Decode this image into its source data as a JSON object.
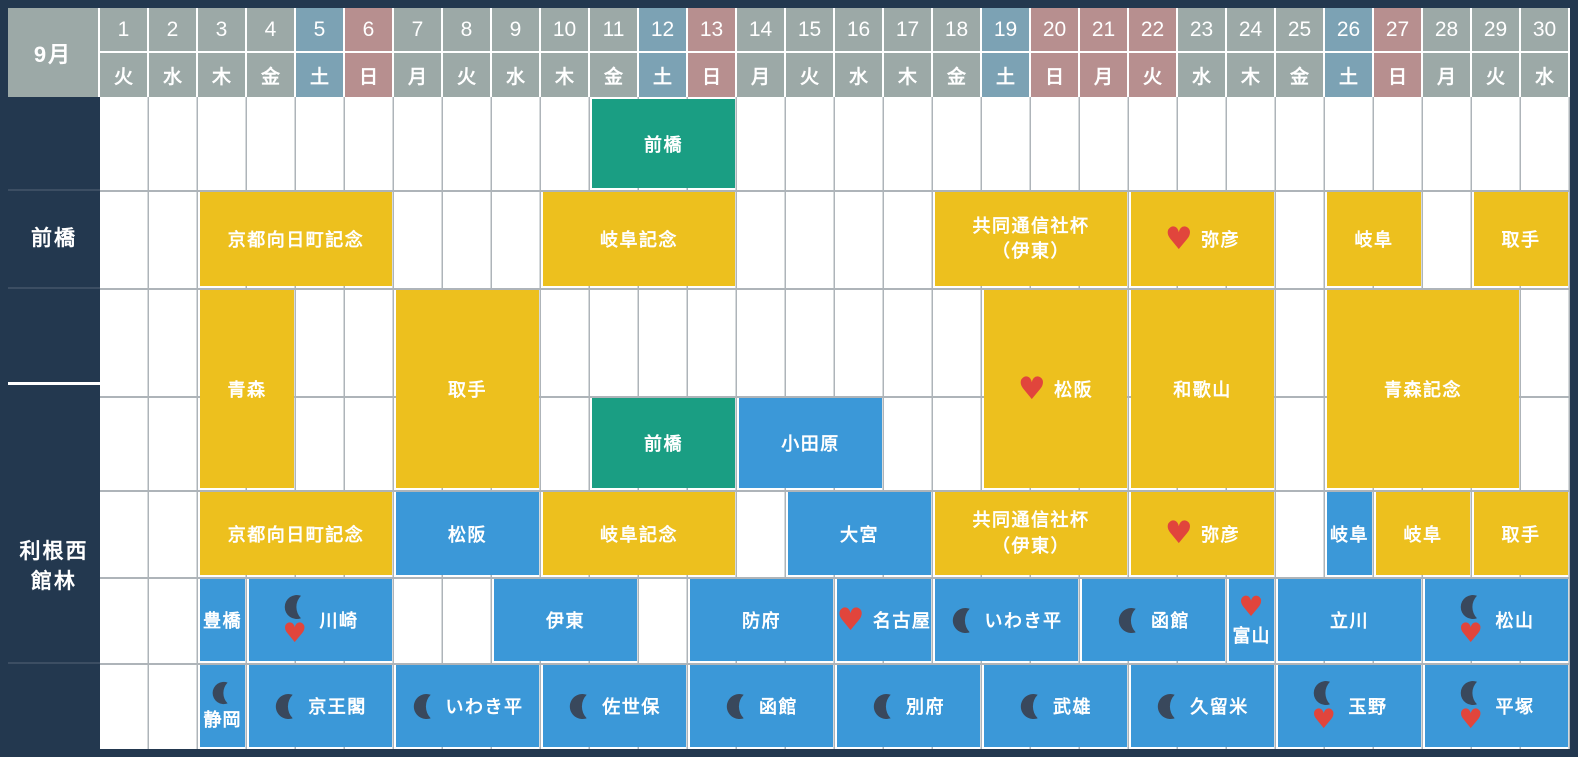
{
  "header": {
    "month_label": "9月",
    "days": [
      {
        "num": "1",
        "dow": "火",
        "type": "normal"
      },
      {
        "num": "2",
        "dow": "水",
        "type": "normal"
      },
      {
        "num": "3",
        "dow": "木",
        "type": "normal"
      },
      {
        "num": "4",
        "dow": "金",
        "type": "normal"
      },
      {
        "num": "5",
        "dow": "土",
        "type": "saturday"
      },
      {
        "num": "6",
        "dow": "日",
        "type": "holiday"
      },
      {
        "num": "7",
        "dow": "月",
        "type": "normal"
      },
      {
        "num": "8",
        "dow": "火",
        "type": "normal"
      },
      {
        "num": "9",
        "dow": "水",
        "type": "normal"
      },
      {
        "num": "10",
        "dow": "木",
        "type": "normal"
      },
      {
        "num": "11",
        "dow": "金",
        "type": "normal"
      },
      {
        "num": "12",
        "dow": "土",
        "type": "saturday"
      },
      {
        "num": "13",
        "dow": "日",
        "type": "holiday"
      },
      {
        "num": "14",
        "dow": "月",
        "type": "normal"
      },
      {
        "num": "15",
        "dow": "火",
        "type": "normal"
      },
      {
        "num": "16",
        "dow": "水",
        "type": "normal"
      },
      {
        "num": "17",
        "dow": "木",
        "type": "normal"
      },
      {
        "num": "18",
        "dow": "金",
        "type": "normal"
      },
      {
        "num": "19",
        "dow": "土",
        "type": "saturday"
      },
      {
        "num": "20",
        "dow": "日",
        "type": "holiday"
      },
      {
        "num": "21",
        "dow": "月",
        "type": "holiday"
      },
      {
        "num": "22",
        "dow": "火",
        "type": "holiday"
      },
      {
        "num": "23",
        "dow": "水",
        "type": "normal"
      },
      {
        "num": "24",
        "dow": "木",
        "type": "normal"
      },
      {
        "num": "25",
        "dow": "金",
        "type": "normal"
      },
      {
        "num": "26",
        "dow": "土",
        "type": "saturday"
      },
      {
        "num": "27",
        "dow": "日",
        "type": "holiday"
      },
      {
        "num": "28",
        "dow": "月",
        "type": "normal"
      },
      {
        "num": "29",
        "dow": "火",
        "type": "normal"
      },
      {
        "num": "30",
        "dow": "水",
        "type": "normal"
      }
    ]
  },
  "sidebar": {
    "sections": [
      {
        "label": ""
      },
      {
        "label": "前橋"
      },
      {
        "label": ""
      },
      {
        "label_lines": [
          "利根西",
          "館林"
        ]
      }
    ]
  },
  "events": [
    {
      "row": "A",
      "start": 11,
      "end": 13,
      "color": "green",
      "label": "前橋"
    },
    {
      "row": "B",
      "start": 3,
      "end": 6,
      "color": "yellow",
      "label": "京都向日町記念"
    },
    {
      "row": "B",
      "start": 10,
      "end": 13,
      "color": "yellow",
      "label": "岐阜記念"
    },
    {
      "row": "B",
      "start": 18,
      "end": 21,
      "color": "yellow",
      "lines": [
        "共同通信社杯",
        "（伊東）"
      ]
    },
    {
      "row": "B",
      "start": 22,
      "end": 24,
      "color": "yellow",
      "label": "弥彦",
      "heart": true,
      "layout": "inline"
    },
    {
      "row": "B",
      "start": 26,
      "end": 27,
      "color": "yellow",
      "label": "岐阜"
    },
    {
      "row": "B",
      "start": 29,
      "end": 30,
      "color": "yellow",
      "label": "取手"
    },
    {
      "row": "CD",
      "start": 3,
      "end": 4,
      "color": "yellow",
      "label": "青森"
    },
    {
      "row": "CD",
      "start": 7,
      "end": 9,
      "color": "yellow",
      "label": "取手"
    },
    {
      "row": "CD",
      "start": 19,
      "end": 21,
      "color": "yellow",
      "label": "松阪",
      "heart": true,
      "layout": "inline"
    },
    {
      "row": "CD",
      "start": 22,
      "end": 24,
      "color": "yellow",
      "label": "和歌山"
    },
    {
      "row": "CD",
      "start": 26,
      "end": 29,
      "color": "yellow",
      "label": "青森記念"
    },
    {
      "row": "D",
      "start": 11,
      "end": 13,
      "color": "green",
      "label": "前橋"
    },
    {
      "row": "D",
      "start": 14,
      "end": 16,
      "color": "blue",
      "label": "小田原"
    },
    {
      "row": "E",
      "start": 3,
      "end": 6,
      "color": "yellow",
      "label": "京都向日町記念"
    },
    {
      "row": "E",
      "start": 7,
      "end": 9,
      "color": "blue",
      "label": "松阪"
    },
    {
      "row": "E",
      "start": 10,
      "end": 13,
      "color": "yellow",
      "label": "岐阜記念"
    },
    {
      "row": "E",
      "start": 15,
      "end": 17,
      "color": "blue",
      "label": "大宮"
    },
    {
      "row": "E",
      "start": 18,
      "end": 21,
      "color": "yellow",
      "lines": [
        "共同通信社杯",
        "（伊東）"
      ]
    },
    {
      "row": "E",
      "start": 22,
      "end": 24,
      "color": "yellow",
      "label": "弥彦",
      "heart": true,
      "layout": "inline"
    },
    {
      "row": "E",
      "start": 26,
      "end": 26,
      "color": "blue",
      "label": "岐阜"
    },
    {
      "row": "E",
      "start": 27,
      "end": 28,
      "color": "yellow",
      "label": "岐阜"
    },
    {
      "row": "E",
      "start": 29,
      "end": 30,
      "color": "yellow",
      "label": "取手"
    },
    {
      "row": "F",
      "start": 3,
      "end": 3,
      "color": "blue",
      "label": "豊橋"
    },
    {
      "row": "F",
      "start": 4,
      "end": 6,
      "color": "blue",
      "label": "川崎",
      "moon": true,
      "heart": true,
      "layout": "stack"
    },
    {
      "row": "F",
      "start": 9,
      "end": 11,
      "color": "blue",
      "label": "伊東"
    },
    {
      "row": "F",
      "start": 13,
      "end": 15,
      "color": "blue",
      "label": "防府"
    },
    {
      "row": "F",
      "start": 16,
      "end": 17,
      "color": "blue",
      "label": "名古屋",
      "heart": true,
      "layout": "inline"
    },
    {
      "row": "F",
      "start": 18,
      "end": 20,
      "color": "blue",
      "label": "いわき平",
      "moon": true,
      "layout": "inline"
    },
    {
      "row": "F",
      "start": 21,
      "end": 23,
      "color": "blue",
      "label": "函館",
      "moon": true,
      "layout": "inline"
    },
    {
      "row": "F",
      "start": 24,
      "end": 24,
      "color": "blue",
      "label": "富山",
      "heart": true,
      "layout": "above"
    },
    {
      "row": "F",
      "start": 25,
      "end": 27,
      "color": "blue",
      "label": "立川"
    },
    {
      "row": "F",
      "start": 28,
      "end": 30,
      "color": "blue",
      "label": "松山",
      "moon": true,
      "heart": true,
      "layout": "stack"
    },
    {
      "row": "G",
      "start": 3,
      "end": 3,
      "color": "blue",
      "label": "静岡",
      "moon": true,
      "layout": "above"
    },
    {
      "row": "G",
      "start": 4,
      "end": 6,
      "color": "blue",
      "label": "京王閣",
      "moon": true,
      "layout": "inline"
    },
    {
      "row": "G",
      "start": 7,
      "end": 9,
      "color": "blue",
      "label": "いわき平",
      "moon": true,
      "layout": "inline"
    },
    {
      "row": "G",
      "start": 10,
      "end": 12,
      "color": "blue",
      "label": "佐世保",
      "moon": true,
      "layout": "inline"
    },
    {
      "row": "G",
      "start": 13,
      "end": 15,
      "color": "blue",
      "label": "函館",
      "moon": true,
      "layout": "inline"
    },
    {
      "row": "G",
      "start": 16,
      "end": 18,
      "color": "blue",
      "label": "別府",
      "moon": true,
      "layout": "inline"
    },
    {
      "row": "G",
      "start": 19,
      "end": 21,
      "color": "blue",
      "label": "武雄",
      "moon": true,
      "layout": "inline"
    },
    {
      "row": "G",
      "start": 22,
      "end": 24,
      "color": "blue",
      "label": "久留米",
      "moon": true,
      "layout": "inline"
    },
    {
      "row": "G",
      "start": 25,
      "end": 27,
      "color": "blue",
      "label": "玉野",
      "moon": true,
      "heart": true,
      "layout": "stack"
    },
    {
      "row": "G",
      "start": 28,
      "end": 30,
      "color": "blue",
      "label": "平塚",
      "moon": true,
      "heart": true,
      "layout": "stack"
    }
  ],
  "colors": {
    "background": "#23384F",
    "header_day": "#9CA9A7",
    "header_saturday": "#7CA2B4",
    "header_sunday_holiday": "#B78F8F",
    "grid_background": "#FFFFFF",
    "grid_line": "#AEB4B9",
    "event_yellow": "#EDC01E",
    "event_blue": "#3B98D8",
    "event_green": "#1A9E83",
    "heart": "#E1453C",
    "moon": "#39485C",
    "text": "#FFFFFF"
  }
}
